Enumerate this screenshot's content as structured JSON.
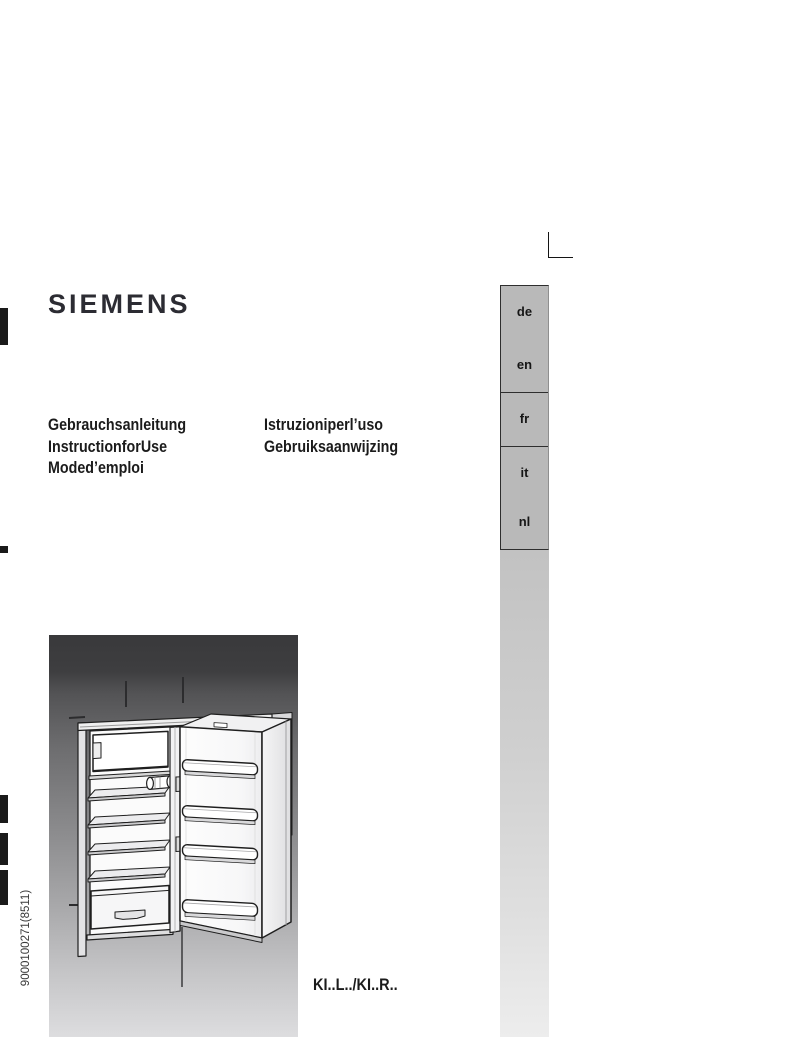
{
  "brand": {
    "logo_text": "SIEMENS"
  },
  "titles": {
    "left_lines": [
      "Gebrauchsanleitung",
      "InstructionforUse",
      "Moded’emploi"
    ],
    "right_lines": [
      "Istruzioniperl’uso",
      "Gebruiksaanwijzing"
    ]
  },
  "language_tabs": {
    "items": [
      {
        "label": "de"
      },
      {
        "label": "en"
      },
      {
        "label": "fr"
      },
      {
        "label": "it"
      },
      {
        "label": "nl"
      }
    ]
  },
  "model_code": "KI..L../KI..R..",
  "print_code": "9000100271(8511)",
  "illustration": {
    "name": "built-in-refrigerator-open-door"
  },
  "colors": {
    "tab_gray": "#b9b9b9",
    "logo_color": "#2c2c33",
    "text_color": "#1b1b1b",
    "mark_black": "#1a1a1a"
  }
}
